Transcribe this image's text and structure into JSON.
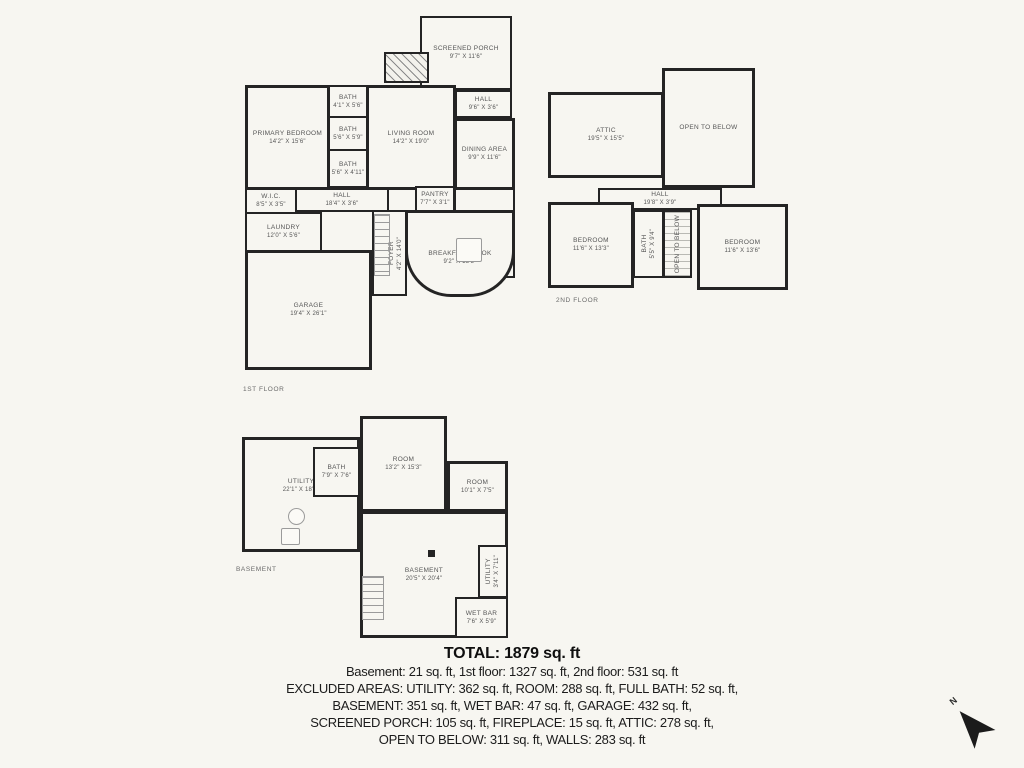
{
  "palette": {
    "background": "#f7f6f1",
    "wall": "#242424",
    "label": "#565656",
    "text": "#1c1c1c"
  },
  "floors": [
    {
      "caption": "1ST FLOOR",
      "rooms": [
        {
          "label": "SCREENED PORCH",
          "dims": "9'7\" X 11'6\""
        },
        {
          "label": "HALL",
          "dims": "9'6\" X 3'6\""
        },
        {
          "label": "PRIMARY BEDROOM",
          "dims": "14'2\" X 15'6\""
        },
        {
          "label": "BATH",
          "dims": "4'1\" X 5'6\""
        },
        {
          "label": "BATH",
          "dims": "5'6\" X 5'9\""
        },
        {
          "label": "BATH",
          "dims": "5'6\" X 4'11\""
        },
        {
          "label": "LIVING ROOM",
          "dims": "14'2\" X 19'0\""
        },
        {
          "label": "DINING AREA",
          "dims": "9'9\" X 11'6\""
        },
        {
          "label": "W.I.C.",
          "dims": "8'5\" X 3'5\""
        },
        {
          "label": "HALL",
          "dims": "18'4\" X 3'6\""
        },
        {
          "label": "PANTRY",
          "dims": "7'7\" X 3'1\""
        },
        {
          "label": "KITCHEN",
          "dims": "7'4\" X 17'6\""
        },
        {
          "label": "LAUNDRY",
          "dims": "12'0\" X 5'6\""
        },
        {
          "label": "FOYER",
          "dims": "4'2\" X 14'0\""
        },
        {
          "label": "BREAKFAST NOOK",
          "dims": "9'2\" X 15'5\""
        },
        {
          "label": "GARAGE",
          "dims": "19'4\" X 26'1\""
        }
      ]
    },
    {
      "caption": "2ND FLOOR",
      "rooms": [
        {
          "label": "ATTIC",
          "dims": "19'5\" X 15'5\""
        },
        {
          "label": "OPEN TO BELOW",
          "dims": ""
        },
        {
          "label": "HALL",
          "dims": "19'8\" X 3'9\""
        },
        {
          "label": "BEDROOM",
          "dims": "11'6\" X 13'3\""
        },
        {
          "label": "BATH",
          "dims": "5'5\" X 9'4\""
        },
        {
          "label": "OPEN TO BELOW",
          "dims": ""
        },
        {
          "label": "BEDROOM",
          "dims": "11'6\" X 13'6\""
        }
      ]
    },
    {
      "caption": "BASEMENT",
      "rooms": [
        {
          "label": "UTILITY",
          "dims": "22'1\" X 18'4\""
        },
        {
          "label": "BATH",
          "dims": "7'9\" X 7'6\""
        },
        {
          "label": "ROOM",
          "dims": "13'2\" X 15'3\""
        },
        {
          "label": "ROOM",
          "dims": "10'1\" X 7'5\""
        },
        {
          "label": "BASEMENT",
          "dims": "20'5\" X 20'4\""
        },
        {
          "label": "UTILITY",
          "dims": "3'4\" X 7'11\""
        },
        {
          "label": "WET BAR",
          "dims": "7'6\" X 5'9\""
        }
      ]
    }
  ],
  "summary": {
    "total": "TOTAL: 1879 sq. ft",
    "lines": [
      "Basement: 21 sq. ft, 1st floor: 1327 sq. ft, 2nd floor: 531 sq. ft",
      "EXCLUDED AREAS: UTILITY: 362 sq. ft, ROOM: 288 sq. ft, FULL BATH: 52 sq. ft,",
      "BASEMENT: 351 sq. ft, WET BAR: 47 sq. ft, GARAGE: 432 sq. ft,",
      "SCREENED PORCH: 105 sq. ft, FIREPLACE: 15 sq. ft, ATTIC: 278 sq. ft,",
      "OPEN TO BELOW: 311 sq. ft, WALLS: 283 sq. ft"
    ]
  },
  "compass": {
    "label": "N"
  }
}
